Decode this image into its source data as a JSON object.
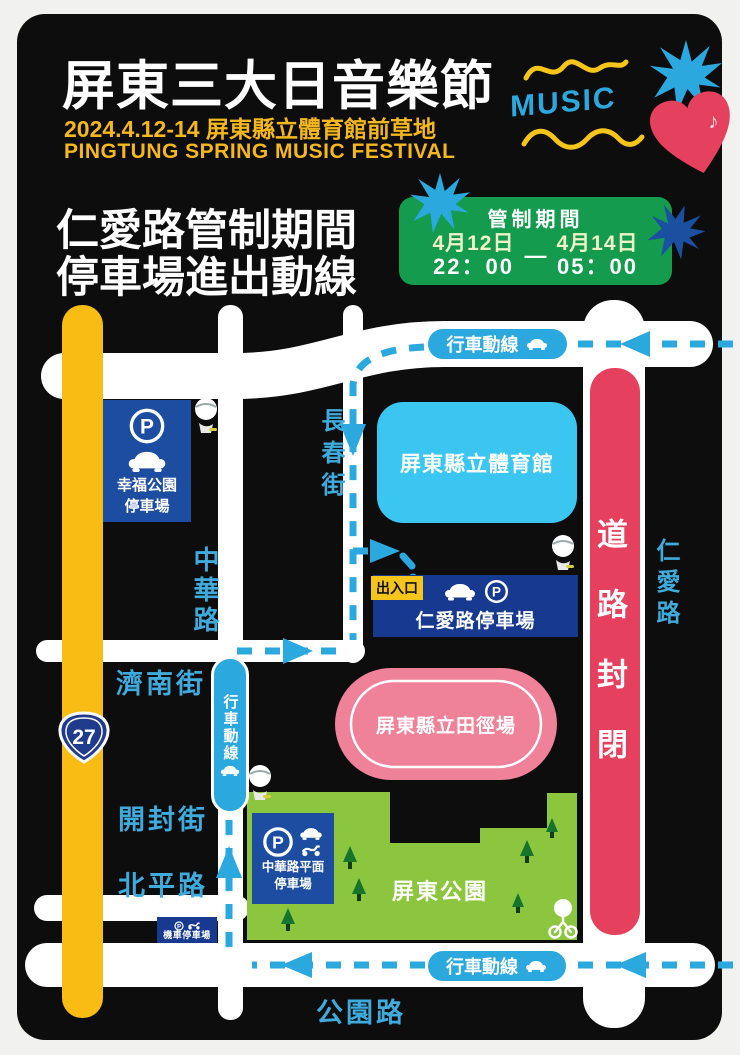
{
  "header": {
    "title": "屏東三大日音樂節",
    "subtitle": "2024.4.12-14 屏東縣立體育館前草地",
    "subtitle_en": "PINGTUNG SPRING MUSIC FESTIVAL",
    "music_word": "MUSIC"
  },
  "notice": {
    "heading_line1": "仁愛路管制期間",
    "heading_line2": "停車場進出動線",
    "control_box": {
      "title": "管制期間",
      "date_start": "4月12日",
      "date_end": "4月14日",
      "separator": "—",
      "time_start": "22：00",
      "time_end": "05：00"
    }
  },
  "map": {
    "route_label": "行車動線",
    "road_closed_label": "道路封閉",
    "entrance_label": "出入口",
    "highway_number": "27",
    "streets": {
      "changchun": "長春街",
      "zhonghua": "中華路",
      "jinan": "濟南街",
      "kaifeng": "開封街",
      "beiping": "北平路",
      "gongyuan": "公園路",
      "renai": "仁愛路"
    },
    "venues": {
      "stadium": "屏東縣立體育館",
      "track": "屏東縣立田徑場",
      "park": "屏東公園"
    },
    "parking": {
      "xingfu_line1": "幸福公園",
      "xingfu_line2": "停車場",
      "renai_lot": "仁愛路停車場",
      "zhonghua_line1": "中華路平面",
      "zhonghua_line2": "停車場",
      "scooter_lot": "機車停車場"
    }
  },
  "icons": {
    "parking_glyph": "P",
    "note_glyph": "♪"
  },
  "colors": {
    "poster_bg": "#0d0d0d",
    "page_bg": "#f1f1ef",
    "yellow": "#f9bc15",
    "route_blue": "#2ba9df",
    "street_label_blue": "#3faadc",
    "red": "#e5405e",
    "pink": "#ef8299",
    "cyan": "#3bc6f2",
    "park_green": "#8cc63e",
    "tree_green": "#17742c",
    "box_green": "#149b4d",
    "sign_blue": "#1d4da0",
    "sign_blue_dark": "#17398f",
    "badge_yellow": "#f5c51c",
    "date_cream": "#eef3c9",
    "title_yellow": "#f5b81c"
  }
}
